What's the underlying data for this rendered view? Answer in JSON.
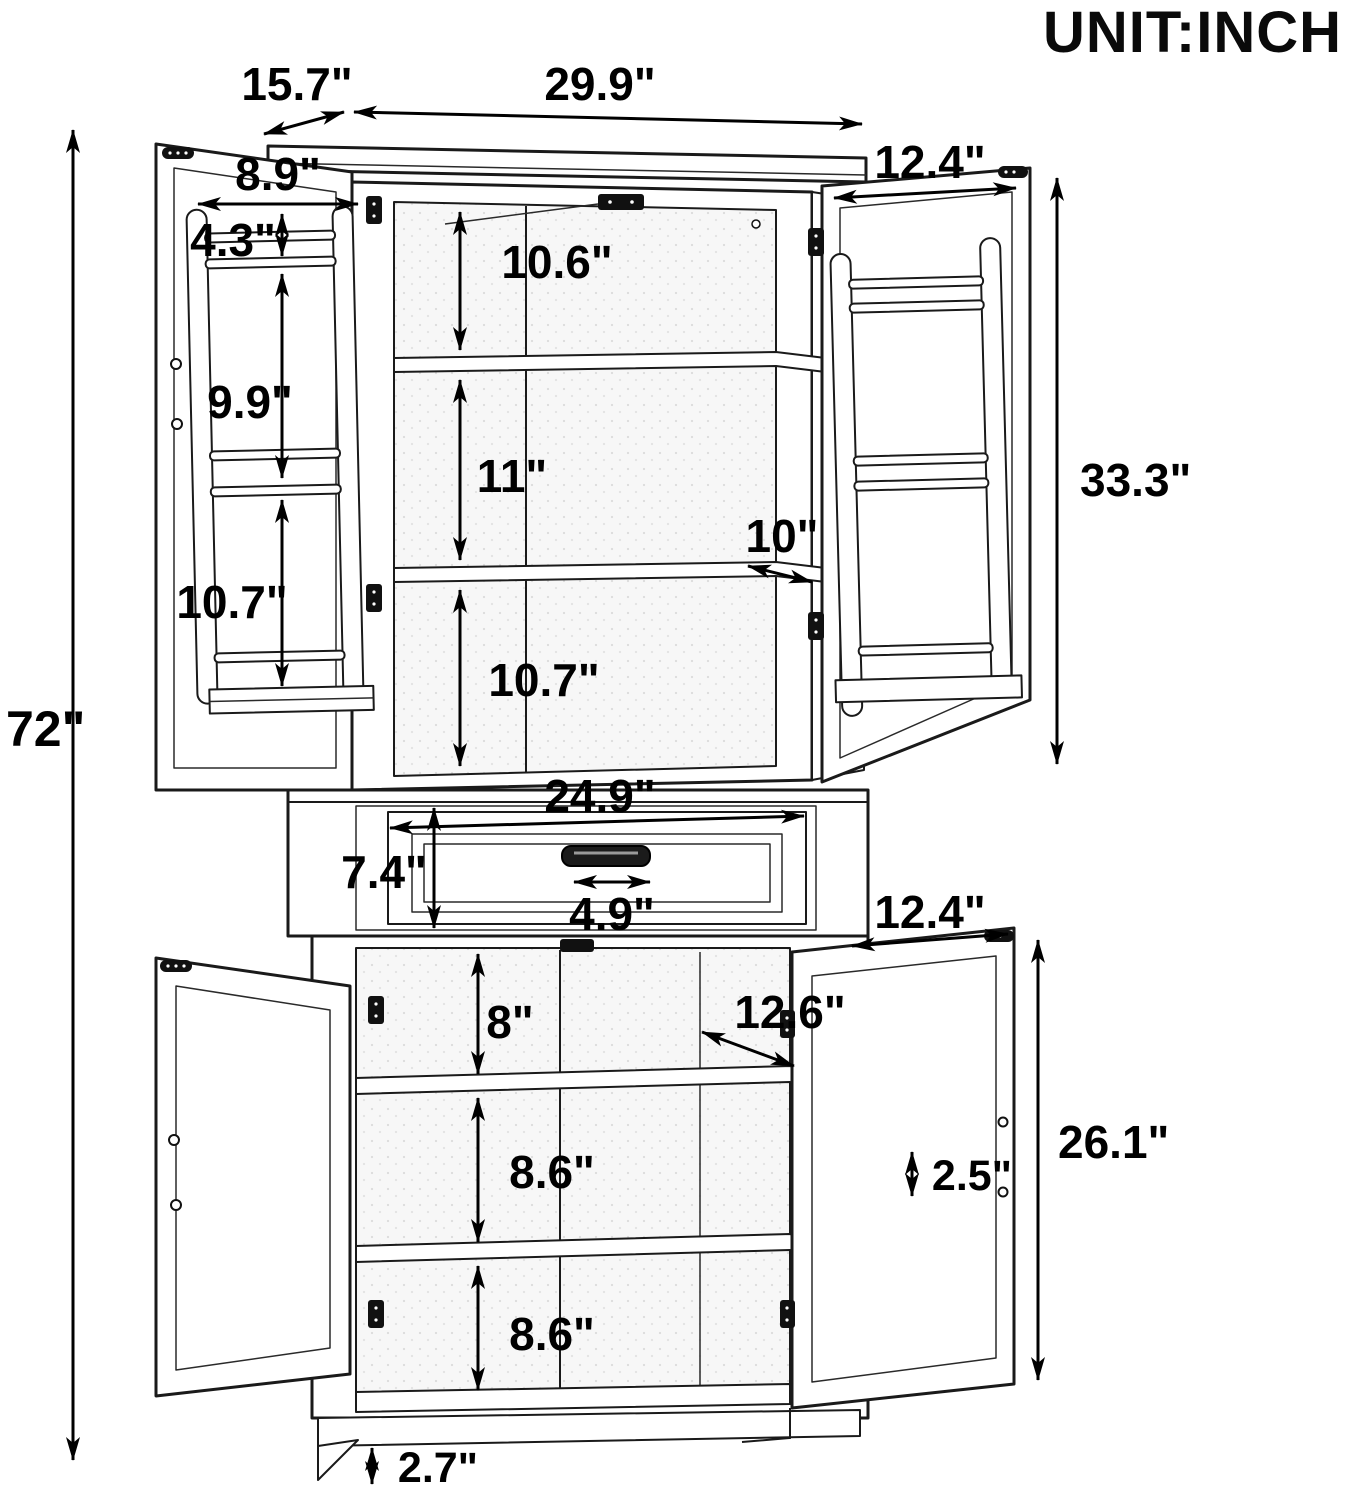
{
  "header": {
    "unit_label": "UNIT:INCH"
  },
  "colors": {
    "line": "#1a1a1a",
    "text": "#000000",
    "background": "#ffffff"
  },
  "dims": {
    "overall_height": "72\"",
    "top": {
      "depth": "15.7\"",
      "width": "29.9\""
    },
    "upper_doors": {
      "door_width": "12.4\"",
      "door_height": "33.3\"",
      "rack_width": "8.9\"",
      "rack_top_gap": "4.3\"",
      "rack_mid_gap": "9.9\"",
      "rack_bottom_gap": "10.7\""
    },
    "upper_interior": {
      "top_space": "10.6\"",
      "middle_space": "11\"",
      "shelf_depth": "10\"",
      "bottom_space": "10.7\""
    },
    "drawer": {
      "width": "24.9\"",
      "height": "7.4\"",
      "handle_width": "4.9\""
    },
    "lower_doors": {
      "door_width": "12.4\"",
      "door_height": "26.1\""
    },
    "lower_interior": {
      "top_space": "8\"",
      "shelf_depth": "12.6\"",
      "middle_space": "8.6\"",
      "shelf_gap": "2.5\"",
      "bottom_space": "8.6\""
    },
    "base_height": "2.7\""
  }
}
